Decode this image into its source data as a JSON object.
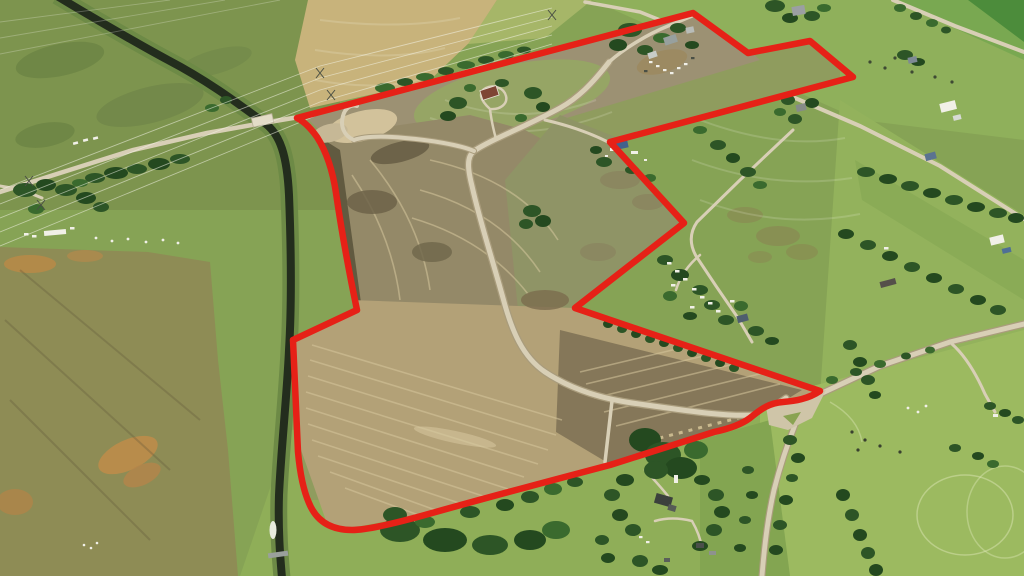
{
  "scene": {
    "kind": "aerial-photograph",
    "description": "Oblique drone photo of rural prairie farmland. A large development parcel with graded dirt, a new curving road and bare subdivided fields is outlined by a thick red boundary line. An irrigation canal with a bridge runs along the west side, transmission lines cross the northwest pastures, and acreage farmsteads with trees, barns and parked trailers surround the parcel. A Y-road junction touches the southeast corner of the boundary.",
    "width_px": 1024,
    "height_px": 576
  },
  "annotation": {
    "label": "property-boundary",
    "color": "#e62117",
    "stroke_width": 6.5,
    "path": "M297,118 L693,13 L748,53 L810,41 L853,77 L610,142 L684,223 L575,308 L820,391 C808,399 795,401 783,402 C770,403 762,408 750,418 C742,424 728,429 714,432 L610,465 Q500,494 432,513 Q372,530 352,530 Q320,530 309,503 Q301,485 298,452 L293,340 L357,310 Q344,248 336,193 Q331,159 317,137 Q307,123 297,118 Z"
  },
  "palette": {
    "pasture_green": "#86a355",
    "dark_pasture": "#7d944e",
    "crop_tan": "#c8b37b",
    "bare_dirt": "#948968",
    "plowed_tan": "#b3a177",
    "canal_water": "#232d1d",
    "gravel_road": "#d8cfb6",
    "tree_green": "#2d5526",
    "boundary_red": "#e62117"
  },
  "features": {
    "canal": "irrigation-canal-with-weir",
    "bridge": "road-bridge-over-canal",
    "development_site": "graded-subdivision-parcel",
    "junction": "y-road-junction-southeast-corner",
    "power_lines": "transmission-corridor-northwest",
    "farmsteads": "acreages-with-trees-and-trailers"
  }
}
